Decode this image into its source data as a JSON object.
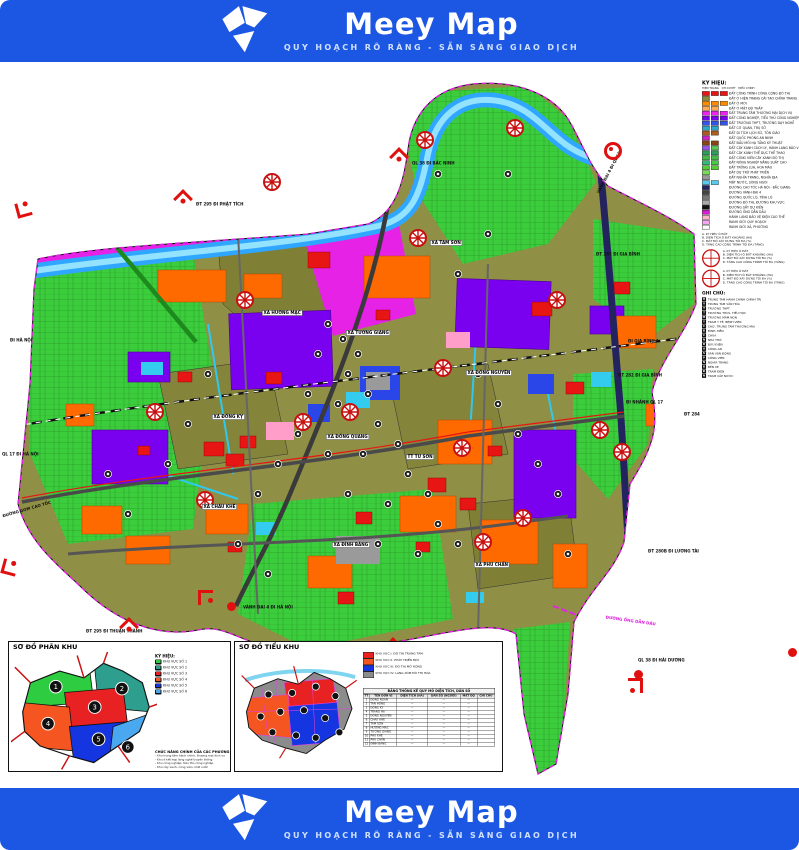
{
  "banner": {
    "product": "Meey Map",
    "tagline": "QUY HOẠCH RÕ RÀNG - SẴN SÀNG GIAO DỊCH",
    "brand_blue": "#1b57e2"
  },
  "map": {
    "villages": [
      {
        "label": "XÃ HƯƠNG MẠC",
        "x": 262,
        "y": 248
      },
      {
        "label": "XÃ TAM SƠN",
        "x": 430,
        "y": 178
      },
      {
        "label": "XÃ TƯƠNG GIANG",
        "x": 346,
        "y": 268
      },
      {
        "label": "XÃ ĐỒNG KỴ",
        "x": 212,
        "y": 352
      },
      {
        "label": "XÃ ĐỒNG QUANG",
        "x": 326,
        "y": 372
      },
      {
        "label": "XÃ ĐỒNG NGUYÊN",
        "x": 466,
        "y": 308
      },
      {
        "label": "TT TỪ SƠN",
        "x": 406,
        "y": 392
      },
      {
        "label": "XÃ CHÂU KHÊ",
        "x": 202,
        "y": 442
      },
      {
        "label": "XÃ ĐÌNH BẢNG",
        "x": 332,
        "y": 480
      },
      {
        "label": "XÃ PHÙ CHẨN",
        "x": 474,
        "y": 500
      }
    ],
    "edge_labels": [
      {
        "label": "ĐT 295 ĐI PHẬT TÍCH",
        "x": 196,
        "y": 140,
        "rot": 0,
        "color": "#111"
      },
      {
        "label": "QL 38 ĐI BẮC NINH",
        "x": 412,
        "y": 99,
        "rot": 0,
        "color": "#111"
      },
      {
        "label": "VÀNH ĐAI 4 ĐI QL 18",
        "x": 596,
        "y": 130,
        "rot": -62,
        "color": "#111"
      },
      {
        "label": "ĐI HÀ NỘI",
        "x": 10,
        "y": 276,
        "rot": 0,
        "color": "#111"
      },
      {
        "label": "QL 17 ĐI HÀ NỘI",
        "x": 2,
        "y": 390,
        "rot": 0,
        "color": "#111"
      },
      {
        "label": "ĐƯỜNG GOM CAO TỐC",
        "x": 2,
        "y": 452,
        "rot": -16,
        "color": "#111"
      },
      {
        "label": "VÀNH ĐAI 4 ĐI HÀ NỘI",
        "x": 243,
        "y": 543,
        "rot": 0,
        "color": "#111"
      },
      {
        "label": "ĐT 295 ĐI THUẬN THÀNH",
        "x": 86,
        "y": 567,
        "rot": 0,
        "color": "#111"
      },
      {
        "label": "ĐI GIA BÌNH 1",
        "x": 628,
        "y": 277,
        "rot": 0,
        "color": "#111"
      },
      {
        "label": "ĐT 282 ĐI GIA BÌNH",
        "x": 618,
        "y": 311,
        "rot": 0,
        "color": "#111"
      },
      {
        "label": "ĐI NHÁNH QL 17",
        "x": 626,
        "y": 338,
        "rot": 0,
        "color": "#111"
      },
      {
        "label": "ĐT 284",
        "x": 684,
        "y": 350,
        "rot": 0,
        "color": "#111"
      },
      {
        "label": "ĐT 280B ĐI LƯƠNG TÀI",
        "x": 648,
        "y": 487,
        "rot": 0,
        "color": "#111"
      },
      {
        "label": "ĐƯỜNG ỐNG DẪN DẦU",
        "x": 606,
        "y": 553,
        "rot": 8,
        "color": "#d81bd8"
      },
      {
        "label": "QL 38 ĐI HẢI DƯƠNG",
        "x": 638,
        "y": 596,
        "rot": 0,
        "color": "#111"
      },
      {
        "label": "ĐT 287 ĐI GIA BÌNH",
        "x": 596,
        "y": 190,
        "rot": 0,
        "color": "#111"
      }
    ],
    "markers": [
      {
        "type": "corner",
        "x": 16,
        "y": 140,
        "rot": -15
      },
      {
        "type": "pin",
        "x": 176,
        "y": 130,
        "rot": 0
      },
      {
        "type": "pin",
        "x": 392,
        "y": 88,
        "rot": 0
      },
      {
        "type": "ring",
        "x": 604,
        "y": 80,
        "rot": 0
      },
      {
        "type": "corner",
        "x": 2,
        "y": 498,
        "rot": 15
      },
      {
        "type": "pin",
        "x": 122,
        "y": 558,
        "rot": 0
      },
      {
        "type": "corner",
        "x": 198,
        "y": 528,
        "rot": 90
      },
      {
        "type": "dot",
        "x": 227,
        "y": 540,
        "rot": 0
      },
      {
        "type": "corner",
        "x": 628,
        "y": 616,
        "rot": 180
      },
      {
        "type": "dot",
        "x": 634,
        "y": 608,
        "rot": 0
      },
      {
        "type": "pin",
        "x": 386,
        "y": 578,
        "rot": 0
      },
      {
        "type": "dot",
        "x": 788,
        "y": 586,
        "rot": 0
      }
    ],
    "interchanges": [
      [
        237,
        226
      ],
      [
        147,
        338
      ],
      [
        342,
        338
      ],
      [
        435,
        294
      ],
      [
        454,
        374
      ],
      [
        515,
        444
      ],
      [
        614,
        378
      ],
      [
        264,
        108
      ],
      [
        410,
        164
      ],
      [
        549,
        226
      ],
      [
        295,
        348
      ],
      [
        197,
        426
      ],
      [
        475,
        468
      ],
      [
        417,
        66
      ],
      [
        507,
        54
      ],
      [
        592,
        356
      ]
    ],
    "facilities": [
      [
        320,
        250
      ],
      [
        335,
        265
      ],
      [
        350,
        280
      ],
      [
        310,
        280
      ],
      [
        340,
        300
      ],
      [
        360,
        320
      ],
      [
        330,
        330
      ],
      [
        300,
        320
      ],
      [
        370,
        350
      ],
      [
        390,
        370
      ],
      [
        355,
        380
      ],
      [
        320,
        380
      ],
      [
        400,
        400
      ],
      [
        420,
        420
      ],
      [
        380,
        430
      ],
      [
        340,
        420
      ],
      [
        430,
        450
      ],
      [
        450,
        470
      ],
      [
        410,
        480
      ],
      [
        370,
        470
      ],
      [
        290,
        360
      ],
      [
        270,
        390
      ],
      [
        250,
        420
      ],
      [
        470,
        300
      ],
      [
        490,
        330
      ],
      [
        510,
        360
      ],
      [
        530,
        390
      ],
      [
        550,
        420
      ],
      [
        200,
        300
      ],
      [
        180,
        350
      ],
      [
        160,
        390
      ],
      [
        450,
        200
      ],
      [
        480,
        160
      ],
      [
        430,
        100
      ],
      [
        500,
        100
      ],
      [
        230,
        470
      ],
      [
        260,
        500
      ],
      [
        560,
        480
      ],
      [
        100,
        400
      ],
      [
        120,
        440
      ]
    ],
    "colors": {
      "residential_existing": "#8f8f45",
      "residential_new": "#ff6a00",
      "public": "#e81515",
      "industry": "#7a00f0",
      "commercial": "#e622e6",
      "agriculture": "#3ccd3c",
      "water": "#2fa6ff",
      "expressway": "#23235f"
    }
  },
  "legend": {
    "title": "KÝ HIỆU:",
    "col_headers": [
      "HIỆN TRẠNG",
      "QH DUYỆT",
      "ĐIỀU CHỈNH"
    ],
    "items": [
      {
        "c": [
          "#e81515",
          "#e81515",
          "#e81515"
        ],
        "label": "ĐẤT CÔNG TRÌNH CÔNG CỘNG ĐÔ THỊ"
      },
      {
        "c": [
          "#8b8b3d",
          null,
          null
        ],
        "label": "ĐẤT Ở HIỆN TRẠNG CẢI TẠO CHỈNH TRANG"
      },
      {
        "c": [
          "#ff8a00",
          "#ff8a00",
          "#ff8a00"
        ],
        "label": "ĐẤT Ở MỚI"
      },
      {
        "c": [
          "#ffaa55",
          "#ffaa55",
          null
        ],
        "label": "ĐẤT Ở MẬT ĐỘ THẤP"
      },
      {
        "c": [
          "#ee22ee",
          "#ee22ee",
          "#ee22ee"
        ],
        "label": "ĐẤT TRUNG TÂM THƯƠNG MẠI DỊCH VỤ"
      },
      {
        "c": [
          "#7a00f0",
          "#7a00f0",
          "#7a00f0"
        ],
        "label": "ĐẤT CÔNG NGHIỆP, TIỂU THỦ CÔNG NGHIỆP"
      },
      {
        "c": [
          "#3355ee",
          "#3355ee",
          "#3355ee"
        ],
        "label": "ĐẤT TRƯỜNG THPT, TRƯỜNG DẠY NGHỀ"
      },
      {
        "c": [
          "#2fa8cc",
          "#2fa8cc",
          null
        ],
        "label": "ĐẤT CƠ QUAN, TRỤ SỞ"
      },
      {
        "c": [
          "#b05a1e",
          "#b05a1e",
          null
        ],
        "label": "ĐẤT DI TÍCH LỊCH SỬ, TÔN GIÁO"
      },
      {
        "c": [
          "#cc22cc",
          null,
          null
        ],
        "label": "ĐẤT QUỐC PHÒNG AN NINH"
      },
      {
        "c": [
          "#8b4513",
          "#8b4513",
          null
        ],
        "label": "ĐẤT ĐẦU MỐI HẠ TẦNG KỸ THUẬT"
      },
      {
        "c": [
          "#9955ee",
          "#55cc55",
          null
        ],
        "label": "ĐẤT CÂY XANH CÁCH LY, HÀNH LANG BẢO VỆ (CÂY...)"
      },
      {
        "c": [
          "#2e9e5b",
          "#2e9e5b",
          null
        ],
        "label": "ĐẤT CÂY XANH THỂ DỤC THỂ THAO"
      },
      {
        "c": [
          "#44bb44",
          "#44bb44",
          null
        ],
        "label": "ĐẤT CÔNG VIÊN CÂY XANH ĐÔ THỊ"
      },
      {
        "c": [
          "#33bb77",
          "#44cc44",
          null
        ],
        "label": "ĐẤT NÔNG NGHIỆP NĂNG SUẤT CAO"
      },
      {
        "c": [
          "#55cc33",
          "#55cc33",
          null
        ],
        "label": "ĐẤT TRỒNG LÚA, HOA MÀU"
      },
      {
        "c": [
          "#77dd55",
          null,
          null
        ],
        "label": "ĐẤT DỰ TRỮ PHÁT TRIỂN"
      },
      {
        "c": [
          "#999999",
          null,
          null
        ],
        "label": "ĐẤT NGHĨA TRANG, NGHĨA ĐỊA"
      },
      {
        "c": [
          "#55ccee",
          "#55ccee",
          null
        ],
        "label": "MẶT NƯỚC, SÔNG NGÒI"
      },
      {
        "c": [
          "#23235f",
          null,
          null
        ],
        "label": "ĐƯỜNG CAO TỐC HÀ NỘI - BẮC GIANG"
      },
      {
        "c": [
          "#444444",
          null,
          null
        ],
        "label": "ĐƯỜNG VÀNH ĐAI 4"
      },
      {
        "c": [
          "#777777",
          null,
          null
        ],
        "label": "ĐƯỜNG QUỐC LỘ, TỈNH LỘ"
      },
      {
        "c": [
          "#aaaaaa",
          null,
          null
        ],
        "label": "ĐƯỜNG ĐÔ THỊ, ĐƯỜNG KHU VỰC"
      },
      {
        "c": [
          "#111111",
          null,
          null
        ],
        "label": "ĐƯỜNG SẮT DỰ KIẾN"
      },
      {
        "c": [
          "#d81bd8",
          null,
          null
        ],
        "label": "ĐƯỜNG ỐNG DẪN DẦU"
      },
      {
        "c": [
          "#ffb6c8",
          null,
          null
        ],
        "label": "HÀNH LANG BẢO VỆ ĐIỆN CAO THẾ"
      },
      {
        "c": [
          "#f3a6f3",
          null,
          null
        ],
        "label": "RANH GIỚI QUY HOẠCH"
      },
      {
        "c": [
          "#ffffff",
          null,
          null
        ],
        "label": "RANH GIỚI XÃ, PHƯỜNG"
      }
    ],
    "intro_lines": [
      "A. KÝ HIỆU Ô ĐẤT",
      "B. DIỆN TÍCH Ô ĐẤT KHOẢNG (HA)",
      "C. MẬT ĐỘ XÂY DỰNG TỐI ĐA (%)",
      "D. TẦNG CAO CÔNG TRÌNH TỐI ĐA (TẦNG)"
    ],
    "nodes": [
      {
        "lines": [
          "A. KÝ HIỆU Ô ĐẤT",
          "B. DIỆN TÍCH Ô ĐẤT KHOẢNG (HA)",
          "C. MẬT ĐỘ XÂY DỰNG TỐI ĐA (%)",
          "D. TẦNG CAO CÔNG TRÌNH TỐI ĐA (TẦNG)"
        ]
      },
      {
        "lines": [
          "A. KÝ HIỆU Ô ĐẤT",
          "B. DIỆN TÍCH Ô ĐẤT KHOẢNG (HA)",
          "C. MẬT ĐỘ XÂY DỰNG TỐI ĐA (%)",
          "D. TẦNG CAO CÔNG TRÌNH TỐI ĐA (TẦNG)"
        ]
      }
    ],
    "ghichu_title": "GHI CHÚ:",
    "ghichu": [
      {
        "glyph": "H",
        "label": "TRUNG TÂM HÀNH CHÍNH CHÍNH TRỊ"
      },
      {
        "glyph": "V",
        "label": "TRUNG TÂM VĂN HÓA"
      },
      {
        "glyph": "T",
        "label": "TRƯỜNG THPT"
      },
      {
        "glyph": "T",
        "label": "TRƯỜNG THCS, TIỂU HỌC"
      },
      {
        "glyph": "M",
        "label": "TRƯỜNG MẦM NON"
      },
      {
        "glyph": "Y",
        "label": "TRẠM Y TẾ, BỆNH VIỆN"
      },
      {
        "glyph": "C",
        "label": "CHỢ, TRUNG TÂM THƯƠNG MẠI"
      },
      {
        "glyph": "Đ",
        "label": "ĐÌNH, ĐỀN"
      },
      {
        "glyph": "C",
        "label": "CHÙA"
      },
      {
        "glyph": "N",
        "label": "NHÀ THỜ"
      },
      {
        "glyph": "B",
        "label": "BƯU ĐIỆN"
      },
      {
        "glyph": "A",
        "label": "CÔNG AN"
      },
      {
        "glyph": "S",
        "label": "SÂN VẬN ĐỘNG"
      },
      {
        "glyph": "P",
        "label": "CÔNG VIÊN"
      },
      {
        "glyph": "N",
        "label": "NGHĨA TRANG"
      },
      {
        "glyph": "B",
        "label": "BẾN XE"
      },
      {
        "glyph": "Đ",
        "label": "TRẠM ĐIỆN"
      },
      {
        "glyph": "N",
        "label": "TRẠM CẤP NƯỚC"
      }
    ]
  },
  "insets": {
    "phan_khu": {
      "title": "SƠ ĐỒ PHÂN KHU",
      "legend_title": "KÝ HIỆU:",
      "items": [
        {
          "num": "1",
          "color": "#2ecc40",
          "label": "KHU VỰC SỐ 1"
        },
        {
          "num": "2",
          "color": "#2e9e8e",
          "label": "KHU VỰC SỐ 2"
        },
        {
          "num": "3",
          "color": "#e82222",
          "label": "KHU VỰC SỐ 3"
        },
        {
          "num": "4",
          "color": "#f55520",
          "label": "KHU VỰC SỐ 4"
        },
        {
          "num": "5",
          "color": "#1535e0",
          "label": "KHU VỰC SỐ 5"
        },
        {
          "num": "6",
          "color": "#4aa8f0",
          "label": "KHU VỰC SỐ 6"
        }
      ],
      "notes_title": "CHỨC NĂNG CHÍNH CỦA CÁC PHƯỜNG",
      "notes": [
        "- Khu trung tâm hành chính, thương mại dịch vụ",
        "- Khu ở kết hợp làng nghề truyền thống",
        "- Khu công nghiệp, tiểu thủ công nghiệp",
        "- Khu cây xanh, công viên, mặt nước"
      ]
    },
    "tieu_khu": {
      "title": "SƠ ĐỒ TIỂU KHU",
      "legend_title": "KÝ HIỆU:",
      "items": [
        {
          "color": "#e82222",
          "label": "KHU VỰC I: ĐÔ THỊ TRUNG TÂM"
        },
        {
          "color": "#f55520",
          "label": "KHU VỰC II: PHÁT TRIỂN MỚI"
        },
        {
          "color": "#1535e0",
          "label": "KHU VỰC III: ĐÔ THỊ MỞ RỘNG"
        },
        {
          "color": "#8c8c8c",
          "label": "KHU VỰC IV: LÀNG XÓM ĐÔ THỊ HÓA"
        }
      ],
      "table": {
        "title": "BẢNG THỐNG KÊ QUY MÔ DIỆN TÍCH, DÂN SỐ",
        "headers": [
          "TT",
          "TÊN ĐƠN VỊ",
          "DIỆN TÍCH (HA)",
          "DÂN SỐ (NGƯỜI)",
          "MẬT ĐỘ",
          "GHI CHÚ"
        ],
        "rows": [
          {
            "cells": [
              "1",
              "ĐÔNG NGÀN",
              "—",
              "—",
              "—",
              ""
            ]
          },
          {
            "cells": [
              "2",
              "TÂN HỒNG",
              "—",
              "—",
              "—",
              ""
            ]
          },
          {
            "cells": [
              "3",
              "ĐỒNG KỴ",
              "—",
              "—",
              "—",
              ""
            ]
          },
          {
            "cells": [
              "4",
              "TRANG HẠ",
              "—",
              "—",
              "—",
              ""
            ]
          },
          {
            "cells": [
              "5",
              "ĐỒNG NGUYÊN",
              "—",
              "—",
              "—",
              ""
            ]
          },
          {
            "cells": [
              "6",
              "CHÂU KHÊ",
              "—",
              "—",
              "—",
              ""
            ]
          },
          {
            "cells": [
              "7",
              "TAM SƠN",
              "—",
              "—",
              "—",
              ""
            ]
          },
          {
            "cells": [
              "8",
              "HƯƠNG MẠC",
              "—",
              "—",
              "—",
              ""
            ]
          },
          {
            "cells": [
              "9",
              "TƯƠNG GIANG",
              "—",
              "—",
              "—",
              ""
            ]
          },
          {
            "cells": [
              "10",
              "PHÙ KHÊ",
              "—",
              "—",
              "—",
              ""
            ]
          },
          {
            "cells": [
              "11",
              "PHÙ CHẨN",
              "—",
              "—",
              "—",
              ""
            ]
          },
          {
            "cells": [
              "12",
              "ĐÌNH BẢNG",
              "—",
              "—",
              "—",
              ""
            ]
          }
        ]
      }
    }
  }
}
